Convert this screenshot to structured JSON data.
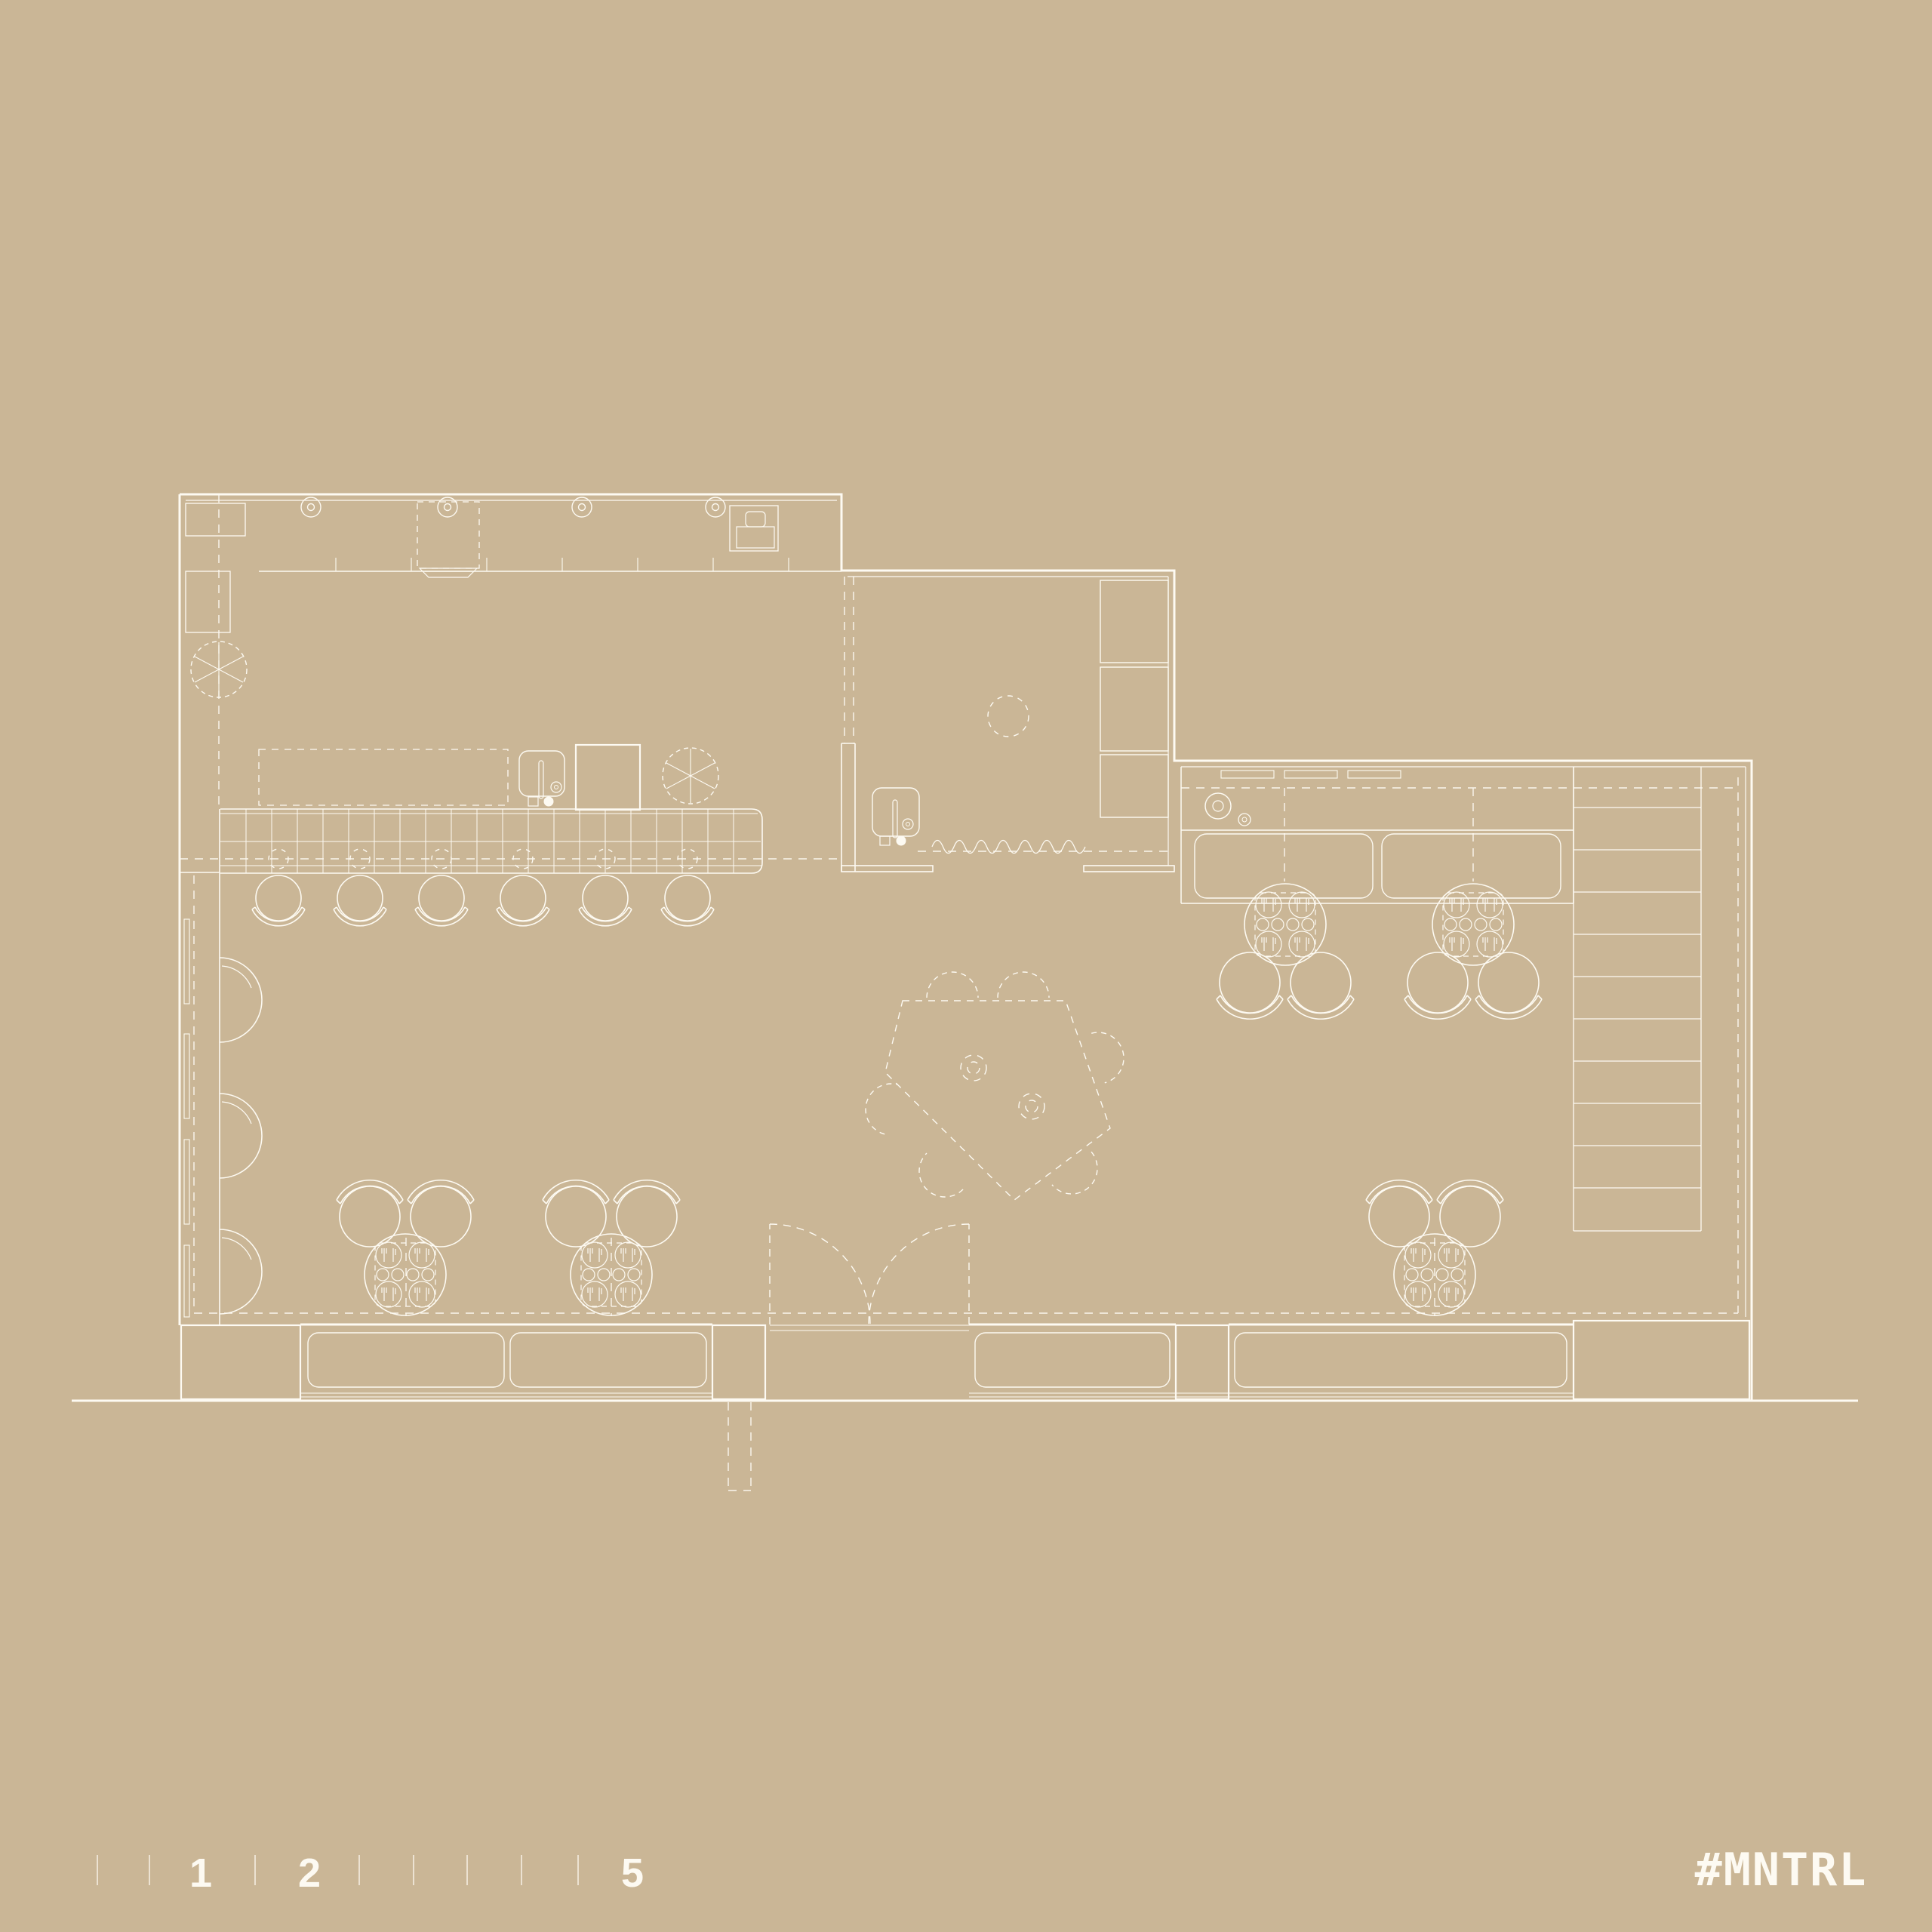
{
  "canvas": {
    "background": "#cab696",
    "line_color": "#fdfaf2"
  },
  "scale_bar": {
    "label_1": "1",
    "label_2": "2",
    "label_5": "5"
  },
  "watermark": {
    "text": "#MNTRL"
  },
  "plan": {
    "type": "restaurant-floor-plan",
    "rooms": [
      "kitchen",
      "prep-room",
      "service-counter",
      "dining-area",
      "staircase"
    ],
    "furniture": {
      "bar_stools": 6,
      "stool_position_markers": 6,
      "wall_half-round_seats": 3,
      "four_top_round_tables": 5,
      "dining_chairs": 10,
      "communal_pentagon_table": 1,
      "pentagon_dashed_seats": 6,
      "planters": 2,
      "sinks": 3,
      "ceiling_lights": 4,
      "wall_cabinets": 5,
      "display_cases": 2,
      "window_benches": 4,
      "stair_treads": 10,
      "entrance": "double-door"
    }
  }
}
